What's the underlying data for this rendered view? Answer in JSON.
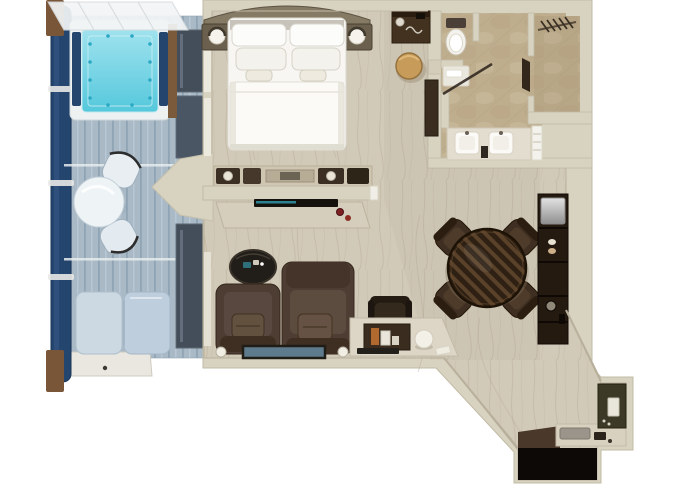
{
  "title": "Suite floor plan — top-down 3D rendering",
  "canvas": {
    "width": 680,
    "height": 486
  },
  "palette": {
    "background": "#ffffff",
    "wall": "#d8d3c0",
    "wall_edge": "#c1bba6",
    "wood_floor": "#d2cab9",
    "wood_grain": "#bfb5a1",
    "bathroom_floor": "#bfae8e",
    "bathroom_floor_light": "#cdbfa2",
    "deck": "#a9b9c6",
    "deck_plank_line": "#8fa4b4",
    "railing_navy": "#24466e",
    "post_brown": "#7a5638",
    "hot_tub_water": "#9fe2ee",
    "hot_tub_water_deep": "#55c8dc",
    "bed_linen": "#f7f6f2",
    "headboard_wood": "#857a64",
    "dark_wood": "#3a2d20",
    "armchair_brown": "#4d3d32",
    "dining_wood_dark": "#2e2013",
    "dining_wood_light": "#5a4129",
    "stool_tan": "#c79b5a",
    "entry_wall_olive": "#3c3a27",
    "entry_floor_black": "#0c0907",
    "accent_red": "#7c2022",
    "artwork_blue": "#5d7b8c",
    "silver": "#c9c9c9"
  },
  "rooms": [
    {
      "id": "veranda",
      "label": "private-veranda",
      "furniture": [
        "hot-tub",
        "glass-canopy",
        "deck-railing",
        "bistro-table",
        "bistro-chair-upper",
        "bistro-chair-lower",
        "sun-lounger"
      ]
    },
    {
      "id": "bedroom",
      "label": "bedroom",
      "furniture": [
        "king-bed",
        "curved-headboard",
        "nightstand-left",
        "nightstand-right",
        "table-lamp-left",
        "table-lamp-right",
        "dresser"
      ]
    },
    {
      "id": "vanity-corridor",
      "label": "dressing-corridor",
      "furniture": [
        "vanity-counter",
        "hair-dryer",
        "vanity-stool",
        "tall-cabinet"
      ]
    },
    {
      "id": "bathroom",
      "label": "bathroom",
      "furniture": [
        "toilet",
        "glass-shower",
        "shower-bench",
        "double-sink-vanity",
        "towel-shelf"
      ]
    },
    {
      "id": "walk-in-closet",
      "label": "walk-in-closet",
      "furniture": [
        "hanging-rail",
        "clothes-hangers",
        "closet-door"
      ]
    },
    {
      "id": "living-dining",
      "label": "living-dining-room",
      "furniture": [
        "tv-console",
        "tv",
        "oval-coffee-table",
        "armchair-left",
        "armchair-right",
        "throw-pillows",
        "floor-lamps",
        "wall-artwork",
        "writing-desk",
        "desk-chair",
        "desk-sphere-lamp",
        "books",
        "round-dining-table",
        "dining-chairs",
        "bar-cabinet",
        "minibar"
      ]
    },
    {
      "id": "entry",
      "label": "entry-hall",
      "furniture": [
        "wardrobe-wall-panel",
        "light-switch",
        "door-mat",
        "shoe-tray"
      ]
    }
  ]
}
